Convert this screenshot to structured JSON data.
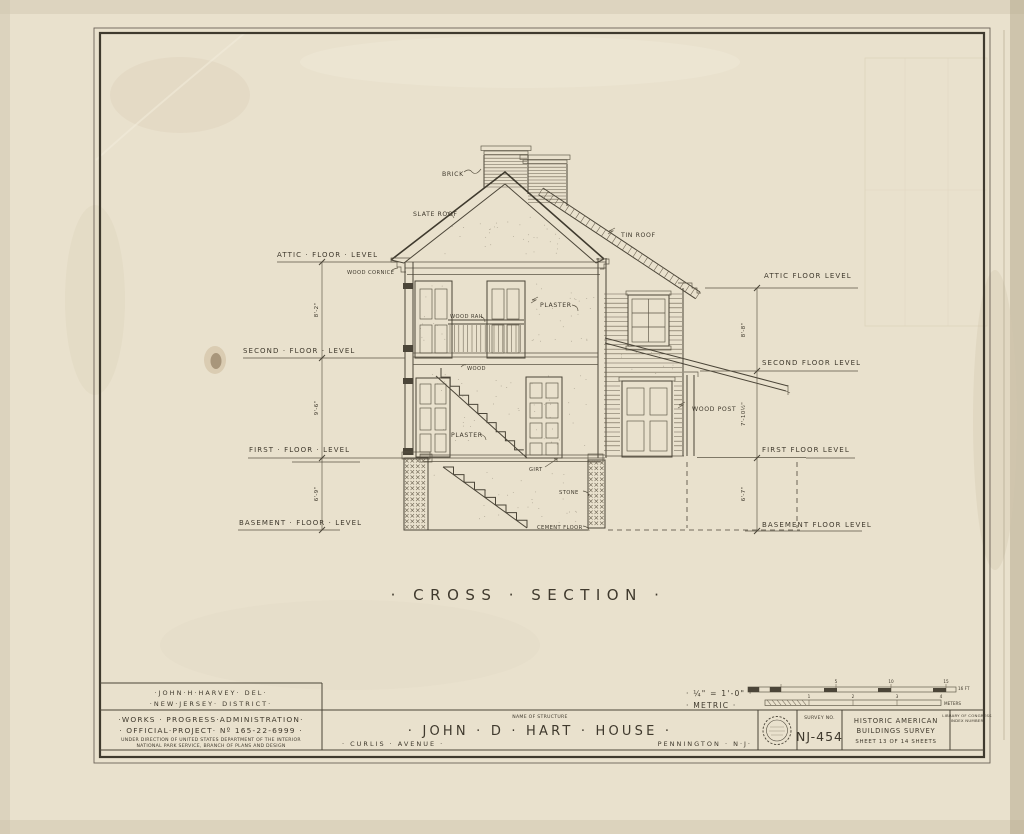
{
  "drawing": {
    "title": "· CROSS · SECTION ·",
    "annotations": {
      "brick": "BRICK",
      "slate_roof": "SLATE ROOF",
      "tin_roof": "TIN ROOF",
      "wood_cornice": "WOOD CORNICE",
      "wood_rail": "WOOD RAIL",
      "plaster_upper": "PLASTER",
      "wood_floor": "WOOD",
      "plaster_lower": "PLASTER",
      "wood_post": "WOOD POST",
      "girt": "GIRT",
      "stone": "STONE",
      "cement_floor": "CEMENT FLOOR"
    },
    "floor_levels_left": [
      {
        "label": "ATTIC · FLOOR · LEVEL",
        "dim": "8'-2\""
      },
      {
        "label": "SECOND · FLOOR · LEVEL",
        "dim": "9'-6\""
      },
      {
        "label": "FIRST · FLOOR · LEVEL",
        "dim": "6'-9\""
      },
      {
        "label": "BASEMENT · FLOOR · LEVEL"
      }
    ],
    "floor_levels_right": [
      {
        "label": "ATTIC FLOOR LEVEL",
        "dim": "8'-8\""
      },
      {
        "label": "SECOND FLOOR LEVEL",
        "dim": "7'-10½\""
      },
      {
        "label": "FIRST FLOOR LEVEL",
        "dim": "6'-7\""
      },
      {
        "label": "BASEMENT FLOOR LEVEL"
      }
    ]
  },
  "scale": {
    "imperial": "· ¼\" = 1'-0\" ·",
    "metric": "· METRIC ·",
    "feet_numbers": [
      "5",
      "10",
      "15"
    ],
    "feet_end": "16 FT",
    "meters_numbers": [
      "1",
      "2",
      "3",
      "4"
    ],
    "meters_end": "METERS"
  },
  "title_block": {
    "delineator_line1": "·JOHN·H·HARVEY· DEL·",
    "delineator_line2": "·NEW·JERSEY· DISTRICT·",
    "agency_line1": "·WORKS · PROGRESS·ADMINISTRATION·",
    "agency_line2": "· OFFICIAL·PROJECT· Nº 165-22-6999 ·",
    "agency_line3": "UNDER DIRECTION OF UNITED STATES DEPARTMENT OF THE INTERIOR",
    "agency_line4": "NATIONAL PARK SERVICE, BRANCH OF PLANS AND DESIGN",
    "name_of_structure_label": "NAME OF STRUCTURE",
    "structure_name": "· JOHN · D · HART · HOUSE ·",
    "address_left": "· CURLIS · AVENUE ·",
    "address_right": "PENNINGTON · N·J·",
    "survey_no_label": "SURVEY NO.",
    "survey_no": "NJ-454",
    "habs_line1": "HISTORIC AMERICAN",
    "habs_line2": "BUILDINGS SURVEY",
    "sheet_line": "SHEET 13 OF 14 SHEETS",
    "library_line1": "LIBRARY OF CONGRESS",
    "library_line2": "INDEX NUMBER"
  }
}
